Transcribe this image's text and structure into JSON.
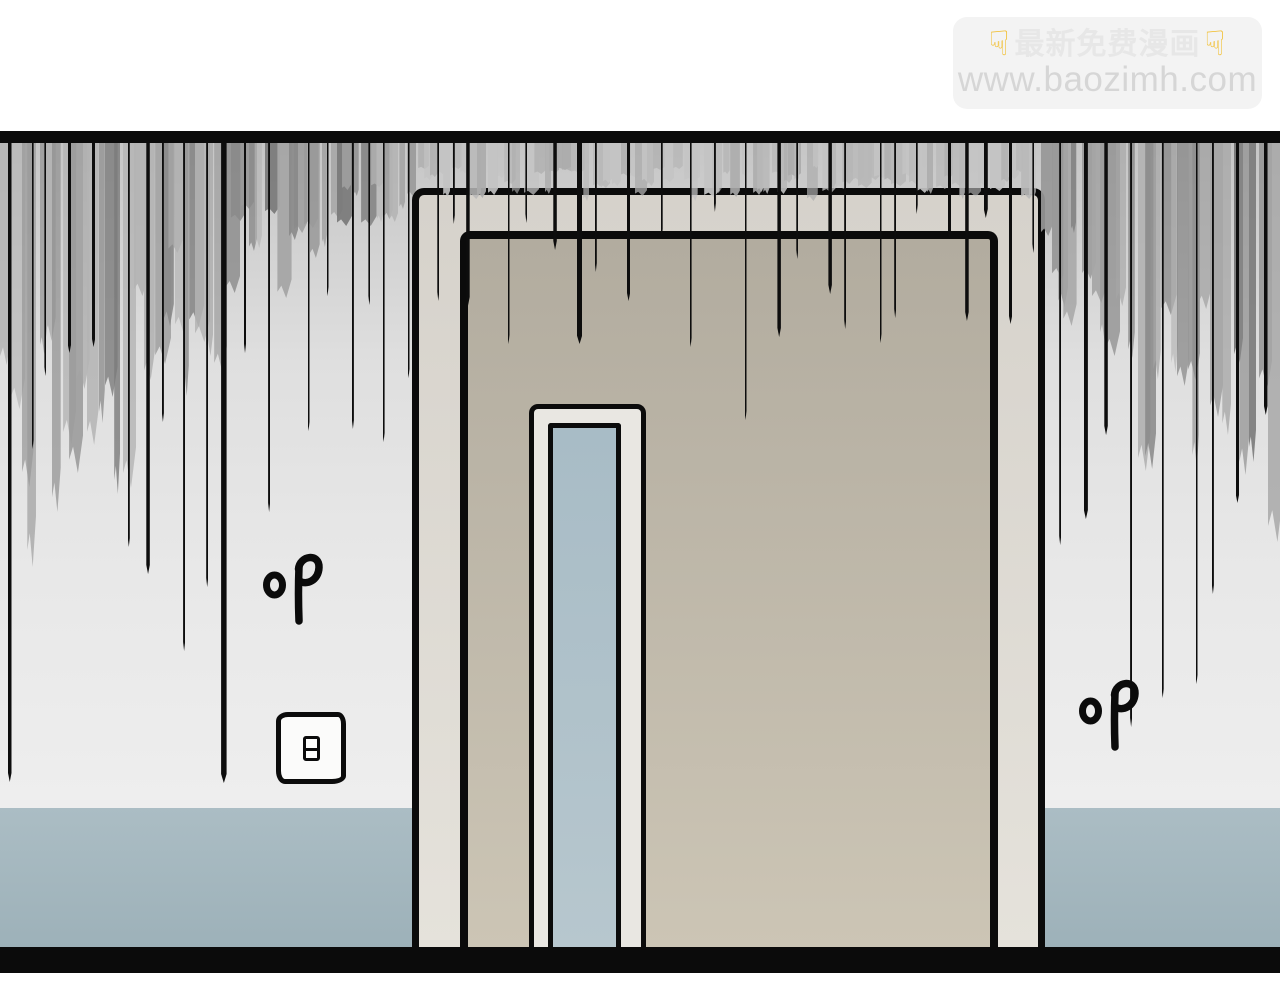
{
  "watermark": {
    "line1": "最新免费漫画",
    "line2": "www.baozimh.com",
    "hand_icon": "☟"
  },
  "sfx": {
    "left": "叩",
    "right": "叩"
  },
  "colors": {
    "ink": "#0b0b0b",
    "wall_top": "#c6c6c6",
    "wall_mid": "#dfdfdf",
    "wall_bottom": "#eeeeee",
    "wainscot_top": "#abbdc4",
    "wainscot_bottom": "#9db1b9",
    "frame_top": "#d6d2cb",
    "frame_bottom": "#e5e2db",
    "door_top": "#b2ac9f",
    "door_bottom": "#ccc5b5",
    "window_frame": "#e9e7e2",
    "glass_top": "#a8bcc6",
    "glass_bottom": "#b7c7ce",
    "wm_bg": "#f3f3f3",
    "wm_text1": "#e7e7e7",
    "wm_text2": "#d6d6d6",
    "wm_hand": "#f2bd2a"
  }
}
